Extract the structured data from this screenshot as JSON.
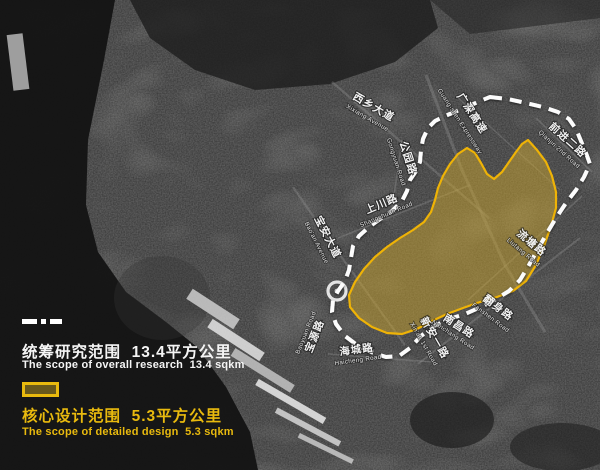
{
  "legend": {
    "research": {
      "title": "统筹研究范围  13.4平方公里",
      "subtitle": "The scope of overall research  13.4 sqkm"
    },
    "core": {
      "title": "核心设计范围  5.3平方公里",
      "subtitle": "The scope of detailed design  5.3 sqkm"
    }
  },
  "colors": {
    "research_line": "#ffffff",
    "core_border": "#efb306",
    "core_fill": "#c9a32d",
    "core_text": "#e9ba0e"
  },
  "map": {
    "labels": [
      {
        "cn": "西乡大道",
        "en": "Xixiang Avenue"
      },
      {
        "cn": "广深高速",
        "en": "Guang-shen Expressway"
      },
      {
        "cn": "公园路",
        "en": "Gongyuan Road"
      },
      {
        "cn": "上川路",
        "en": "Shangchuan Road"
      },
      {
        "cn": "宝安大道",
        "en": "Bao'an Avenue"
      },
      {
        "cn": "宝源路",
        "en": "Baoyuan Road"
      },
      {
        "cn": "海城路",
        "en": "Haicheng Road"
      },
      {
        "cn": "新安一路",
        "en": "Xin'an 1st Road"
      },
      {
        "cn": "南昌路",
        "en": "Nanchang Road"
      },
      {
        "cn": "翻身路",
        "en": "Fanshen Road"
      },
      {
        "cn": "流塘路",
        "en": "Liutang Road"
      },
      {
        "cn": "前进二路",
        "en": "Qianjin 2nd Road"
      }
    ]
  }
}
